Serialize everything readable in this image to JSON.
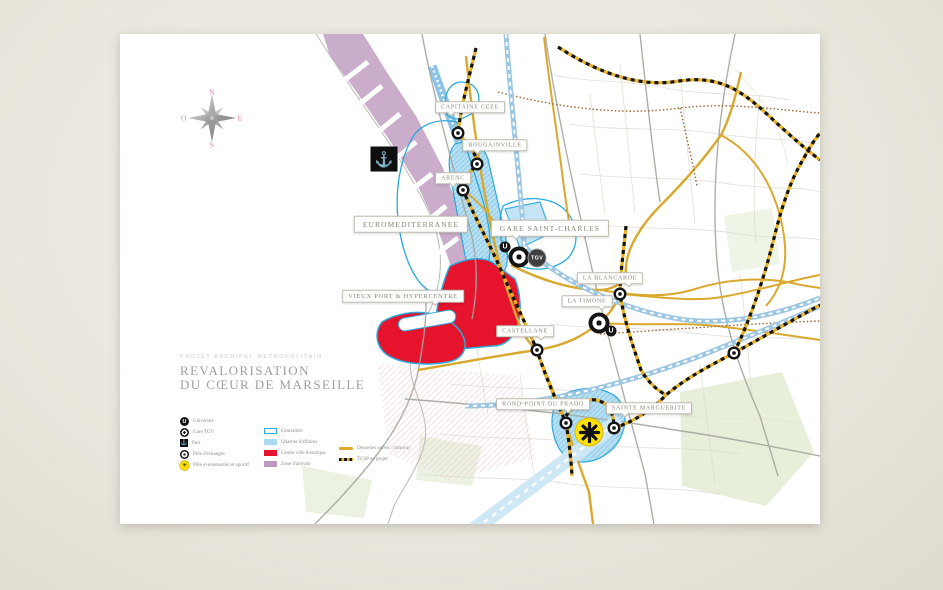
{
  "poster": {
    "kicker": "PROJET ARCHIPEL METROPOLITAIN",
    "title_line1": "REVALORISATION",
    "title_line2": "DU CŒUR DE MARSEILLE"
  },
  "compass": {
    "north": "N",
    "east": "E",
    "south": "S",
    "west": "O"
  },
  "badges": {
    "university": "U",
    "tgv": "TGV",
    "anchor_glyph": "⚓",
    "star_glyph": "✳"
  },
  "map": {
    "labels": [
      {
        "id": "capitaine-geze",
        "text": "CAPITAINE GEZE"
      },
      {
        "id": "bougainville",
        "text": "BOUGAINVILLE"
      },
      {
        "id": "arenc",
        "text": "ARENC"
      },
      {
        "id": "euromediterranee",
        "text": "EUROMEDITERRANEE"
      },
      {
        "id": "gare-saint-charles",
        "text": "GARE SAINT-CHARLES"
      },
      {
        "id": "vieux-port-hypercentre",
        "text": "VIEUX PORT & HYPERCENTRE"
      },
      {
        "id": "la-blancarde",
        "text": "LA BLANCARDE"
      },
      {
        "id": "la-timone",
        "text": "LA TIMONE"
      },
      {
        "id": "castellane",
        "text": "CASTELLANE"
      },
      {
        "id": "rond-point-du-prado",
        "text": "ROND-POINT DU PRADO"
      },
      {
        "id": "sainte-marguerite",
        "text": "SAINTE MARGUERITE"
      }
    ],
    "colors": {
      "centrality_outline": "#2ba9db",
      "business_district": "#a9daf0",
      "historic_center": "#e5132b",
      "activity_zone": "#bb98c0",
      "tramway": "#d9a92e",
      "tcsp_dash_dark": "#141414",
      "tcsp_dash_gold": "#e8b32a"
    }
  },
  "legend": {
    "symbols": [
      {
        "label": "Université"
      },
      {
        "label": "Gare TGV"
      },
      {
        "label": "Port"
      },
      {
        "label": "Pôle d'échanges"
      },
      {
        "label": "Pôle événementiel et sportif"
      }
    ],
    "areas": [
      {
        "label": "Centralités",
        "hex": "#2ba9db"
      },
      {
        "label": "Quartier d'affaires",
        "hex": "#a9daf0"
      },
      {
        "label": "Centre ville historique",
        "hex": "#e5132b"
      },
      {
        "label": "Zone d'activité",
        "hex": "#bb98c0"
      }
    ],
    "lines": [
      {
        "label": "Dessertes autres : tramway",
        "hex": "#d9a92e"
      },
      {
        "label": "TCSP en projet",
        "hex": "#141414"
      }
    ]
  }
}
